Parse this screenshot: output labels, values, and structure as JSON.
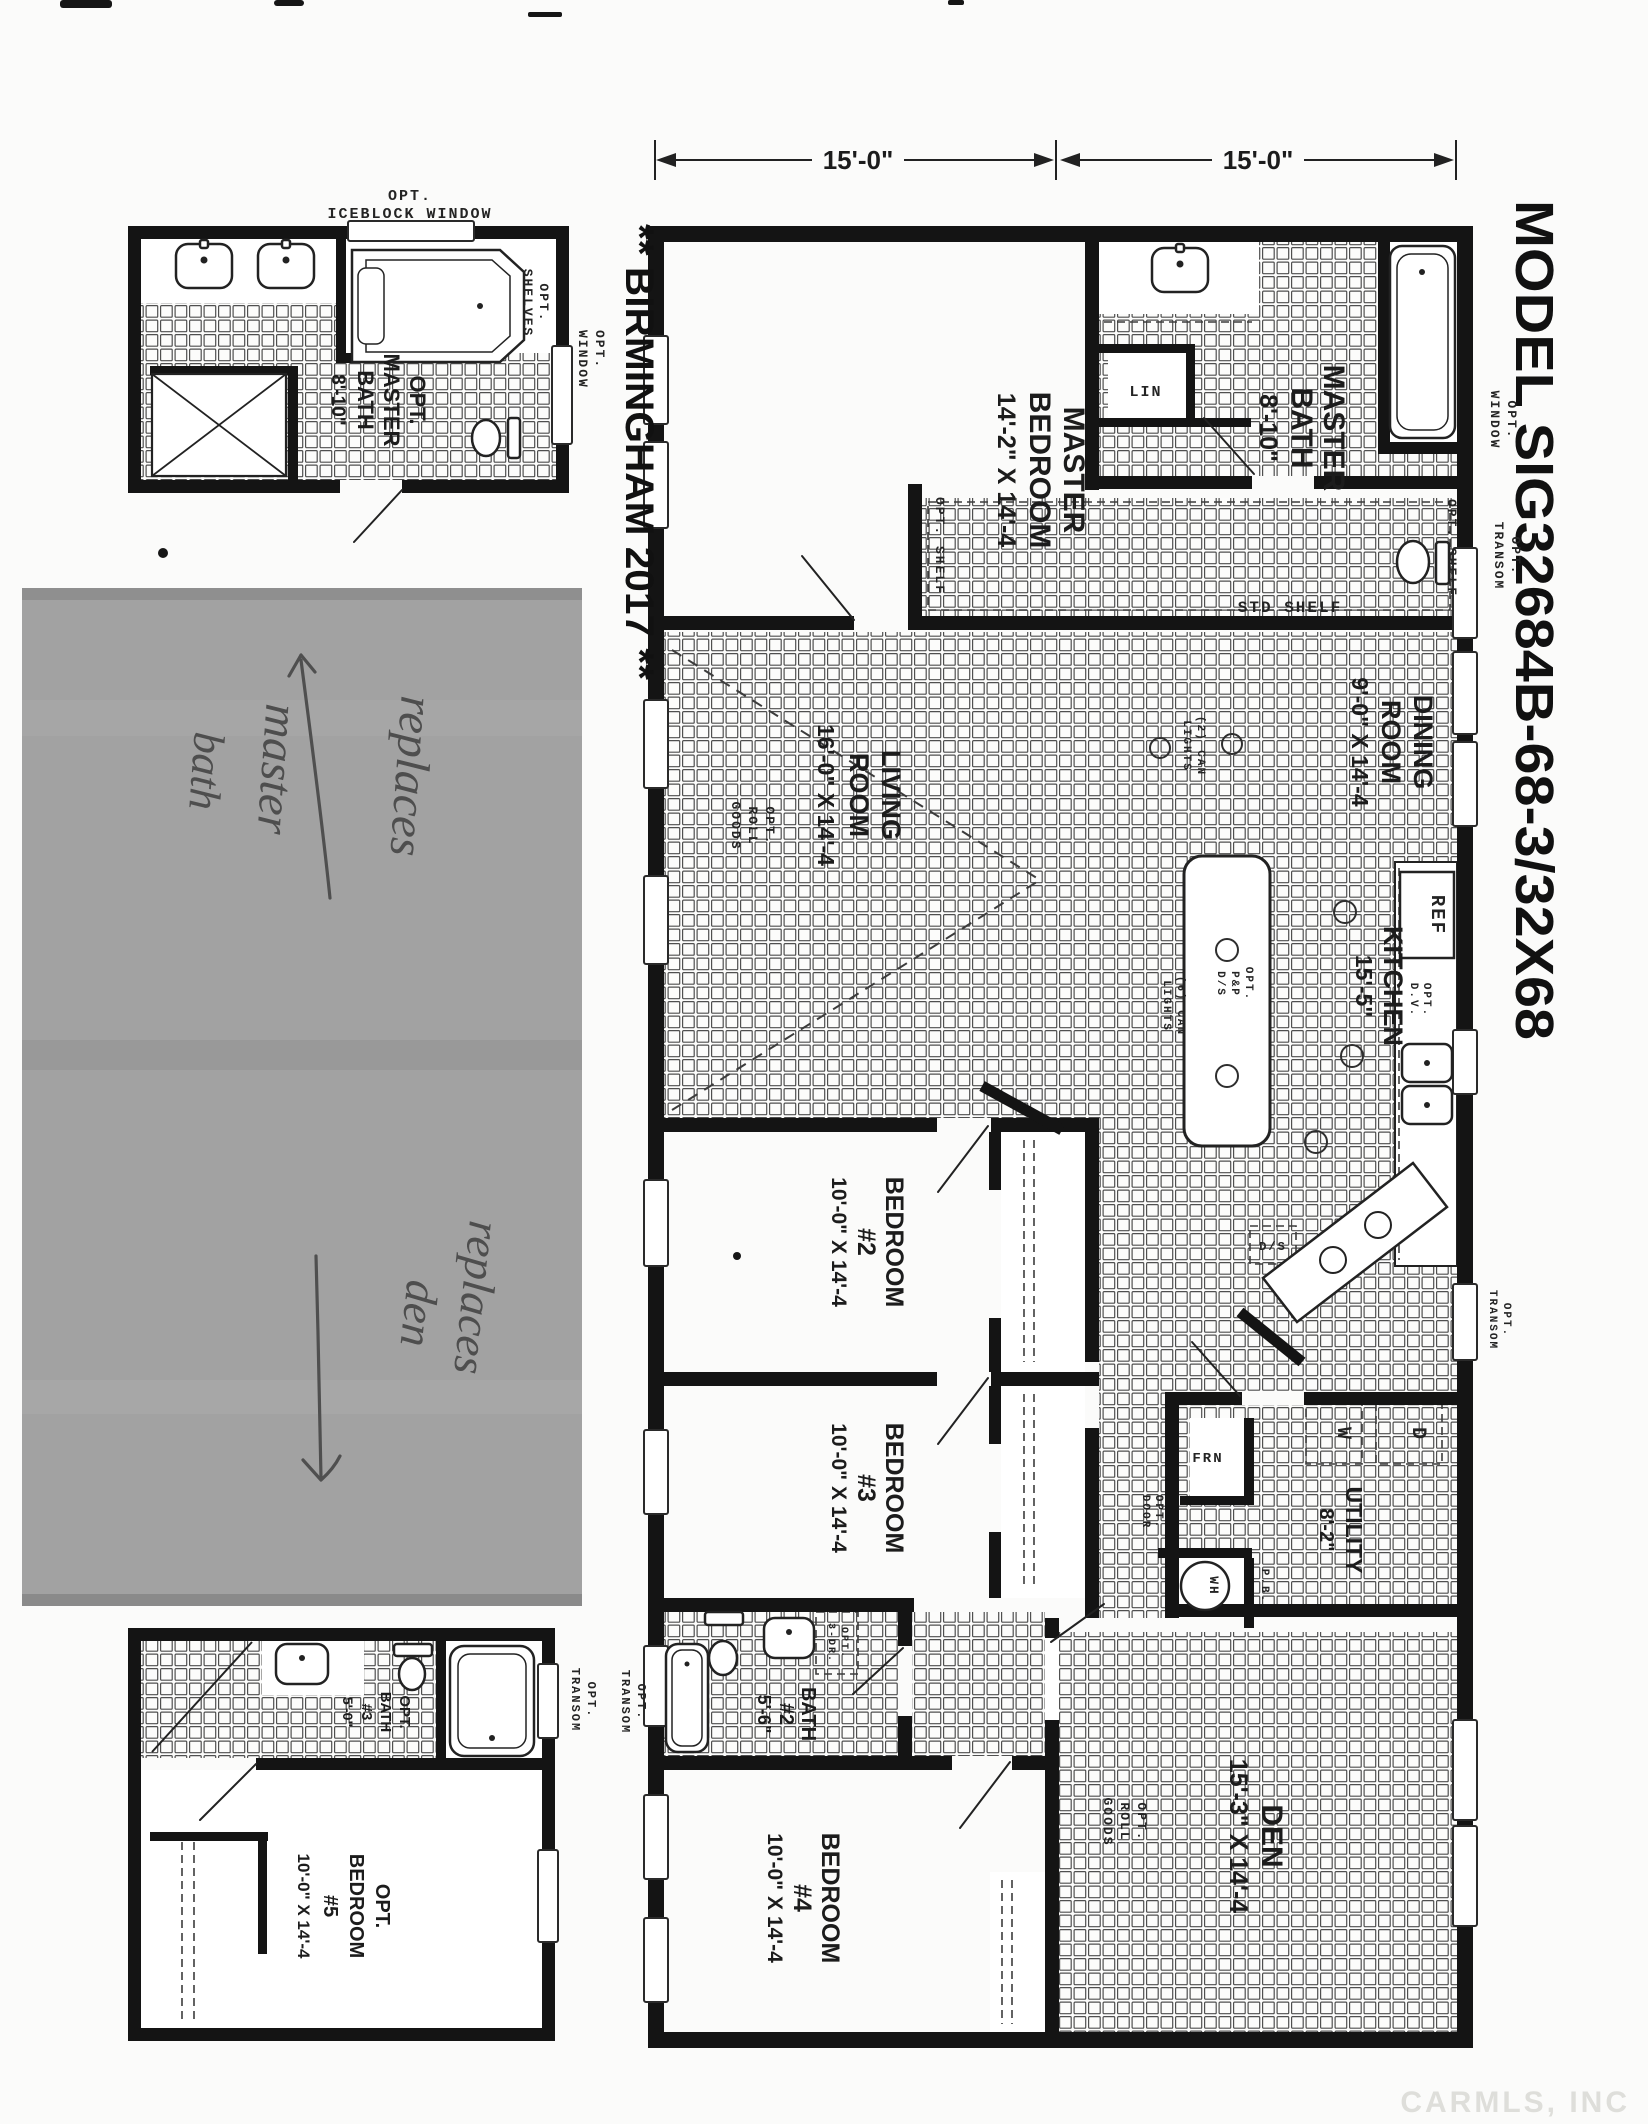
{
  "titles": {
    "model": "MODEL  SIG32684B-68-3/32X68",
    "series": "** BIRMINGHAM 2017 **"
  },
  "dimensions": {
    "left": "15'-0\"",
    "right": "15'-0\""
  },
  "rooms": {
    "master_bedroom": {
      "l1": "MASTER",
      "l2": "BEDROOM",
      "size": "14'-2\" X 14'-4"
    },
    "master_bath": {
      "l1": "MASTER",
      "l2": "BATH",
      "size": "8'-10\""
    },
    "dining": {
      "l1": "DINING",
      "l2": "ROOM",
      "size": "9'-0\" X 14'-4"
    },
    "living": {
      "l1": "LIVING",
      "l2": "ROOM",
      "size": "16'-0\" X 14'-4"
    },
    "kitchen": {
      "l1": "KITCHEN",
      "size": "15'-5\""
    },
    "bedroom2": {
      "l1": "BEDROOM",
      "l2": "#2",
      "size": "10'-0\" X 14'-4"
    },
    "bedroom3": {
      "l1": "BEDROOM",
      "l2": "#3",
      "size": "10'-0\" X 14'-4"
    },
    "bath2": {
      "l1": "BATH",
      "l2": "#2",
      "size": "5'-6\""
    },
    "bedroom4": {
      "l1": "BEDROOM",
      "l2": "#4",
      "size": "10'-0\" X 14'-4"
    },
    "den": {
      "l1": "DEN",
      "size": "15'-3\" X 14'-4"
    },
    "utility": {
      "l1": "UTILITY",
      "size": "8'-2\""
    },
    "opt_master_bath": {
      "l1": "OPT.",
      "l2": "MASTER",
      "l3": "BATH",
      "size": "8'-10\""
    },
    "opt_bath3": {
      "l1": "OPT.",
      "l2": "BATH",
      "l3": "#3",
      "size": "5'-0\""
    },
    "opt_bedroom5": {
      "l1": "OPT.",
      "l2": "BEDROOM",
      "l3": "#5",
      "size": "10'-0\" X 14'-4"
    }
  },
  "annotations": {
    "opt": "OPT.",
    "window": "WINDOW",
    "transom": "TRANSOM",
    "shelves": "SHELVES",
    "iceblock": "ICEBLOCK WINDOW",
    "opt_shelf": "OPT. SHELF",
    "std_shelf": "STD SHELF",
    "lin": "LIN",
    "ref": "REF",
    "frn": "FRN",
    "washer": "W",
    "dryer": "D",
    "water_heater": "WH",
    "pb": "P.B.",
    "ds": "D/S",
    "dv": "D.V.",
    "door": "DOOR",
    "three_dr": "3-DR.",
    "roll": "ROLL",
    "goods": "GOODS",
    "can2": "(2) CAN",
    "can6": "(6) CAN",
    "lights": "LIGHTS",
    "pp": "P&P"
  },
  "handwriting": {
    "note1_l1": "replaces",
    "note1_l2": "master",
    "note1_l3": "bath",
    "note2_l1": "replaces",
    "note2_l2": "den"
  },
  "watermark": "CARMLS, INC"
}
